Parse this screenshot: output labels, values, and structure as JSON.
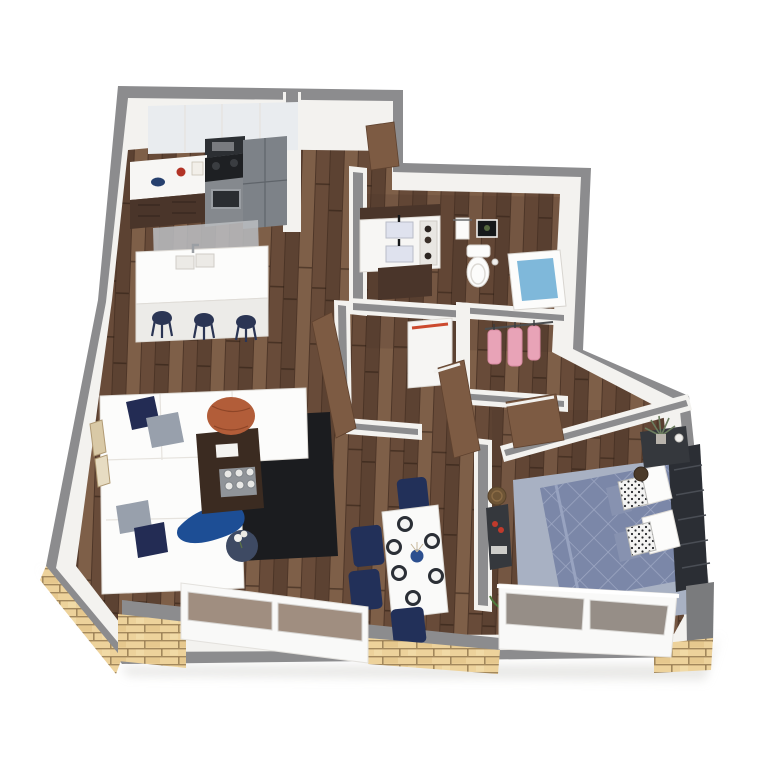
{
  "scene": {
    "kind": "3d-floor-plan-render",
    "view": "rotated-top-down-perspective",
    "background": "#ffffff"
  },
  "colors": {
    "background": "#ffffff",
    "wall_cap": "#8c8c8e",
    "wall_cap_dark": "#7a7b7d",
    "wall_face": "#f3f2ef",
    "wall_face_shade": "#e4e2de",
    "floor_base": "#6d4f3c",
    "floor_dark": "#5c4232",
    "floor_mid": "#684b39",
    "floor_light": "#7e5f48",
    "brick_base": "#edd29b",
    "brick_mortar": "#8a6f47",
    "window_frame": "#f9f9f8",
    "window_glass": "#8a7463",
    "rug_kitchen": "#b9bcbf",
    "rug_living": "#1b1c1f",
    "rug_bedroom": "#a8b1c3",
    "sofa": "#f8f8f7",
    "pillow_navy": "#232c54",
    "pillow_gray": "#98a0ac",
    "throw_blue": "#1d4e95",
    "coffee_table": "#3b2b21",
    "pouf": "#b25d39",
    "side_table": "#3e4a63",
    "island": "#fbfbfa",
    "stool": "#2b3554",
    "cabinet_dark": "#4a352a",
    "cabinet_upper": "#e9ecef",
    "counter": "#f7f6f4",
    "appliance_steel": "#85898e",
    "appliance_dark": "#2c2f33",
    "fridge": "#7d8288",
    "door_wood": "#7d5b43",
    "fixture_white": "#fcfcfb",
    "tub_water": "#7fb8da",
    "closet_pink": "#e8a3b7",
    "duvet": "#7b87a8",
    "duvet_line": "#9ca6c2",
    "denim_pillow": "#8792b0",
    "headboard": "#2b2e34",
    "nightstand": "#35383d",
    "plant_green": "#4e7a3c",
    "flower_red": "#c03a2c",
    "vase_blue": "#2c4f8f",
    "plate_dark": "#2b2f36",
    "chair_navy": "#223059",
    "basket_brown": "#6e5536",
    "art_gold": "#d9c9a6",
    "appliance_stripe": "#cc4a2f"
  },
  "rooms": {
    "kitchen": {
      "items": [
        "upper-cabinets",
        "microwave",
        "range-oven",
        "refrigerator",
        "lower-cabinets-with-counter",
        "counter-decor",
        "kitchen-rug",
        "island-with-double-sink",
        "bar-stools"
      ],
      "stool_count": 3
    },
    "entry_hall": {
      "items": [
        "entry-door",
        "interior-doors",
        "utility-appliance-with-red-stripe"
      ]
    },
    "bathroom": {
      "items": [
        "double-vanity",
        "shelf-unit",
        "towel-bar",
        "wall-art",
        "toilet",
        "bathtub-with-water"
      ]
    },
    "closet": {
      "items": [
        "hanging-rod",
        "pink-garments"
      ],
      "garment_count": 3
    },
    "living_room": {
      "items": [
        "l-shaped-sectional-sofa",
        "throw-pillows",
        "throw-blanket",
        "dark-area-rug",
        "coffee-table-with-tray",
        "magazine",
        "pouf-ottoman",
        "round-side-table",
        "flower-vase",
        "wall-art-frames"
      ],
      "pillow_count": 4
    },
    "dining_area": {
      "items": [
        "dining-table",
        "place-settings",
        "centerpiece-vase",
        "upholstered-chairs"
      ],
      "chair_count": 4,
      "place_setting_count": 6
    },
    "bedroom": {
      "items": [
        "bed-with-quilted-duvet",
        "headboard",
        "white-pillows",
        "patterned-pillows",
        "denim-shams",
        "bedroom-rug",
        "nightstand",
        "potted-plant",
        "jar",
        "dresser-with-flowers",
        "basket",
        "floor-plant"
      ]
    },
    "exterior": {
      "items": [
        "gray-capped-walls",
        "brick-knee-wall",
        "living-window-wall",
        "bedroom-window-wall"
      ],
      "living_window_panes": 2,
      "bedroom_window_panes": 2
    }
  }
}
